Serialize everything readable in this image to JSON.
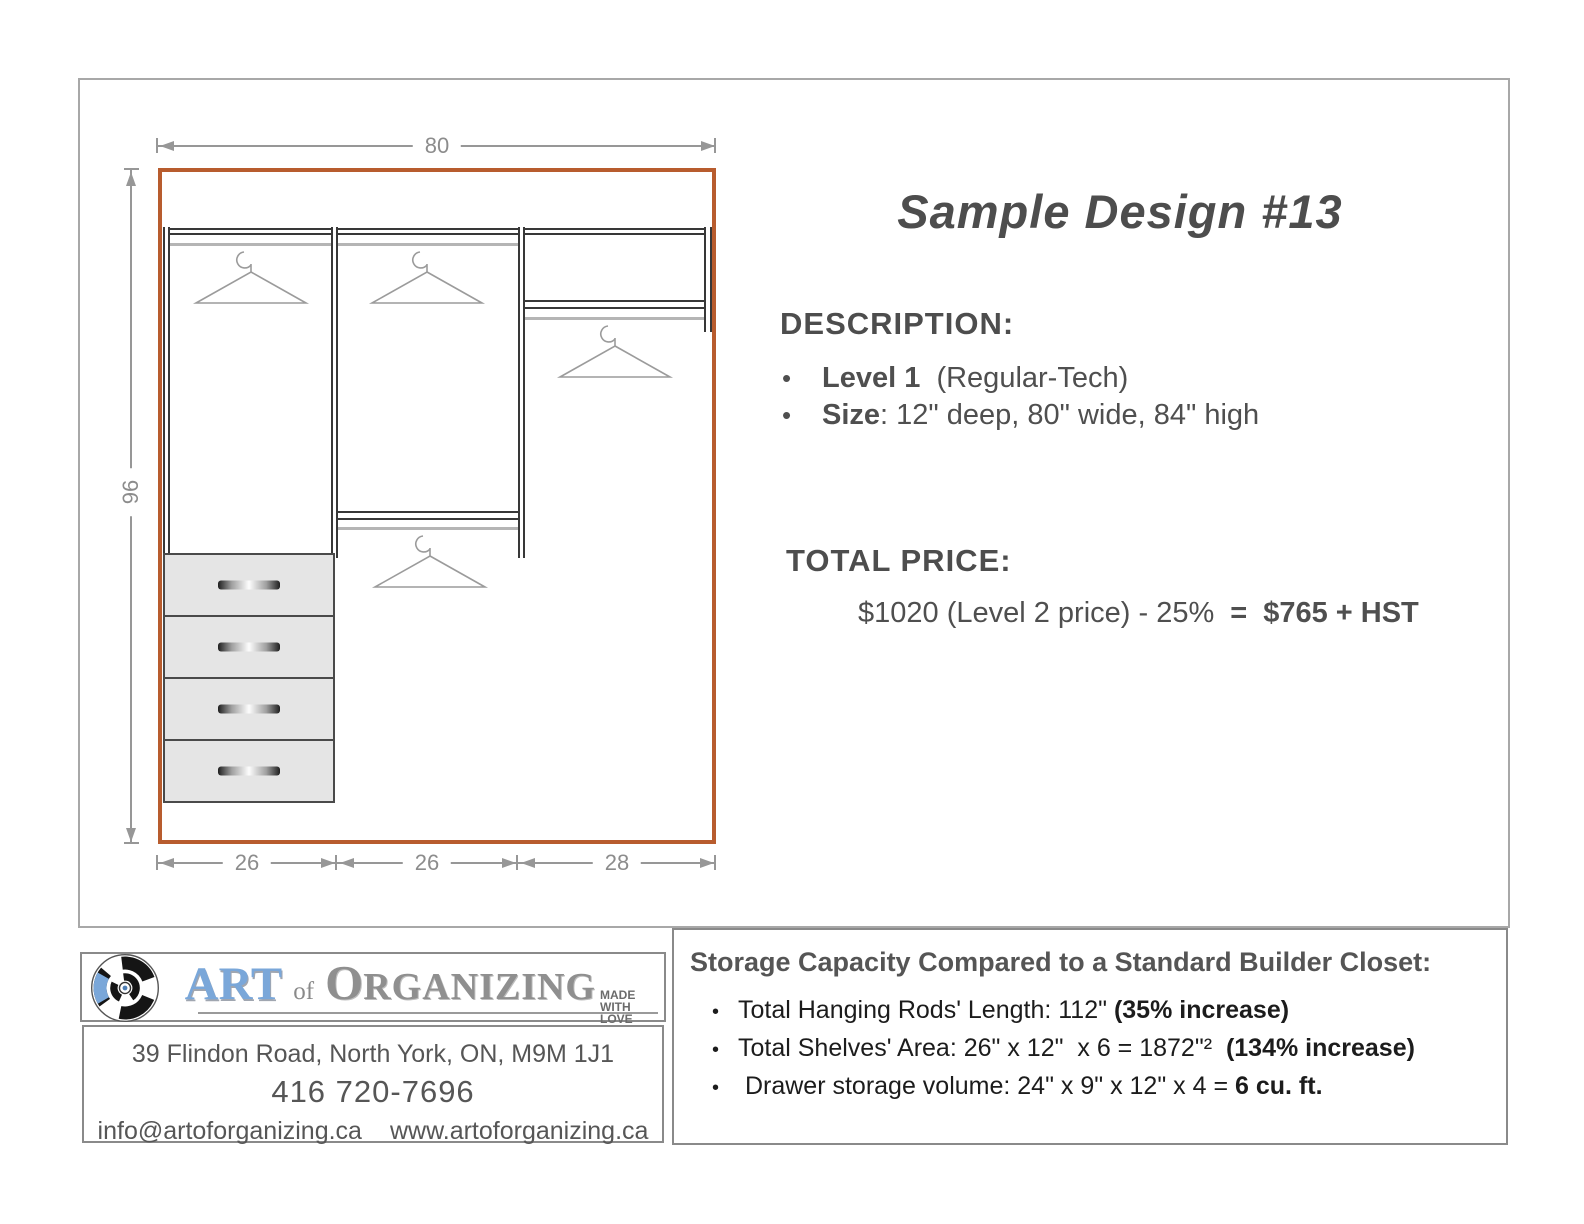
{
  "drawing": {
    "dim_top": "80",
    "dim_left": "96",
    "dim_bottom": [
      "26",
      "26",
      "28"
    ],
    "wall_color": "#b85c2e",
    "hanger_icon": "clothes-hanger"
  },
  "right_panel": {
    "title": "Sample Design #13",
    "description_heading": "DESCRIPTION:",
    "bullet_char": "•",
    "bullets": [
      {
        "bold": "Level 1",
        "rest": "  (Regular-Tech)"
      },
      {
        "bold": "Size",
        "rest": ": 12\" deep, 80\" wide, 84\" high"
      }
    ],
    "price_heading": "TOTAL PRICE:",
    "price": {
      "normal": "$1020 (Level 2 price) - 25%",
      "eq": "=",
      "bold": "$765 + HST"
    }
  },
  "footer": {
    "logo": {
      "art": "ART",
      "of": "of",
      "org_initial": "O",
      "org_rest": "RGANIZING",
      "tagline": [
        "MADE",
        "WITH",
        "LOVE"
      ],
      "art_color": "#7aa7d9"
    },
    "address": "39 Flindon Road, North York, ON, M9M 1J1",
    "phone": "416 720-7696",
    "email": "info@artoforganizing.ca",
    "website": "www.artoforganizing.ca",
    "storage": {
      "heading": "Storage Capacity Compared to a Standard Builder Closet:",
      "bullet_char": "•",
      "items": [
        {
          "normal": "Total Hanging Rods' Length: 112\" ",
          "bold": "(35% increase)"
        },
        {
          "normal": "Total Shelves' Area: 26\" x 12\"  x 6 = 1872\"²  ",
          "bold": "(134% increase)"
        },
        {
          "normal": " Drawer storage volume: 24\" x 9\" x 12\" x 4 = ",
          "bold": "6 cu. ft."
        }
      ]
    }
  }
}
